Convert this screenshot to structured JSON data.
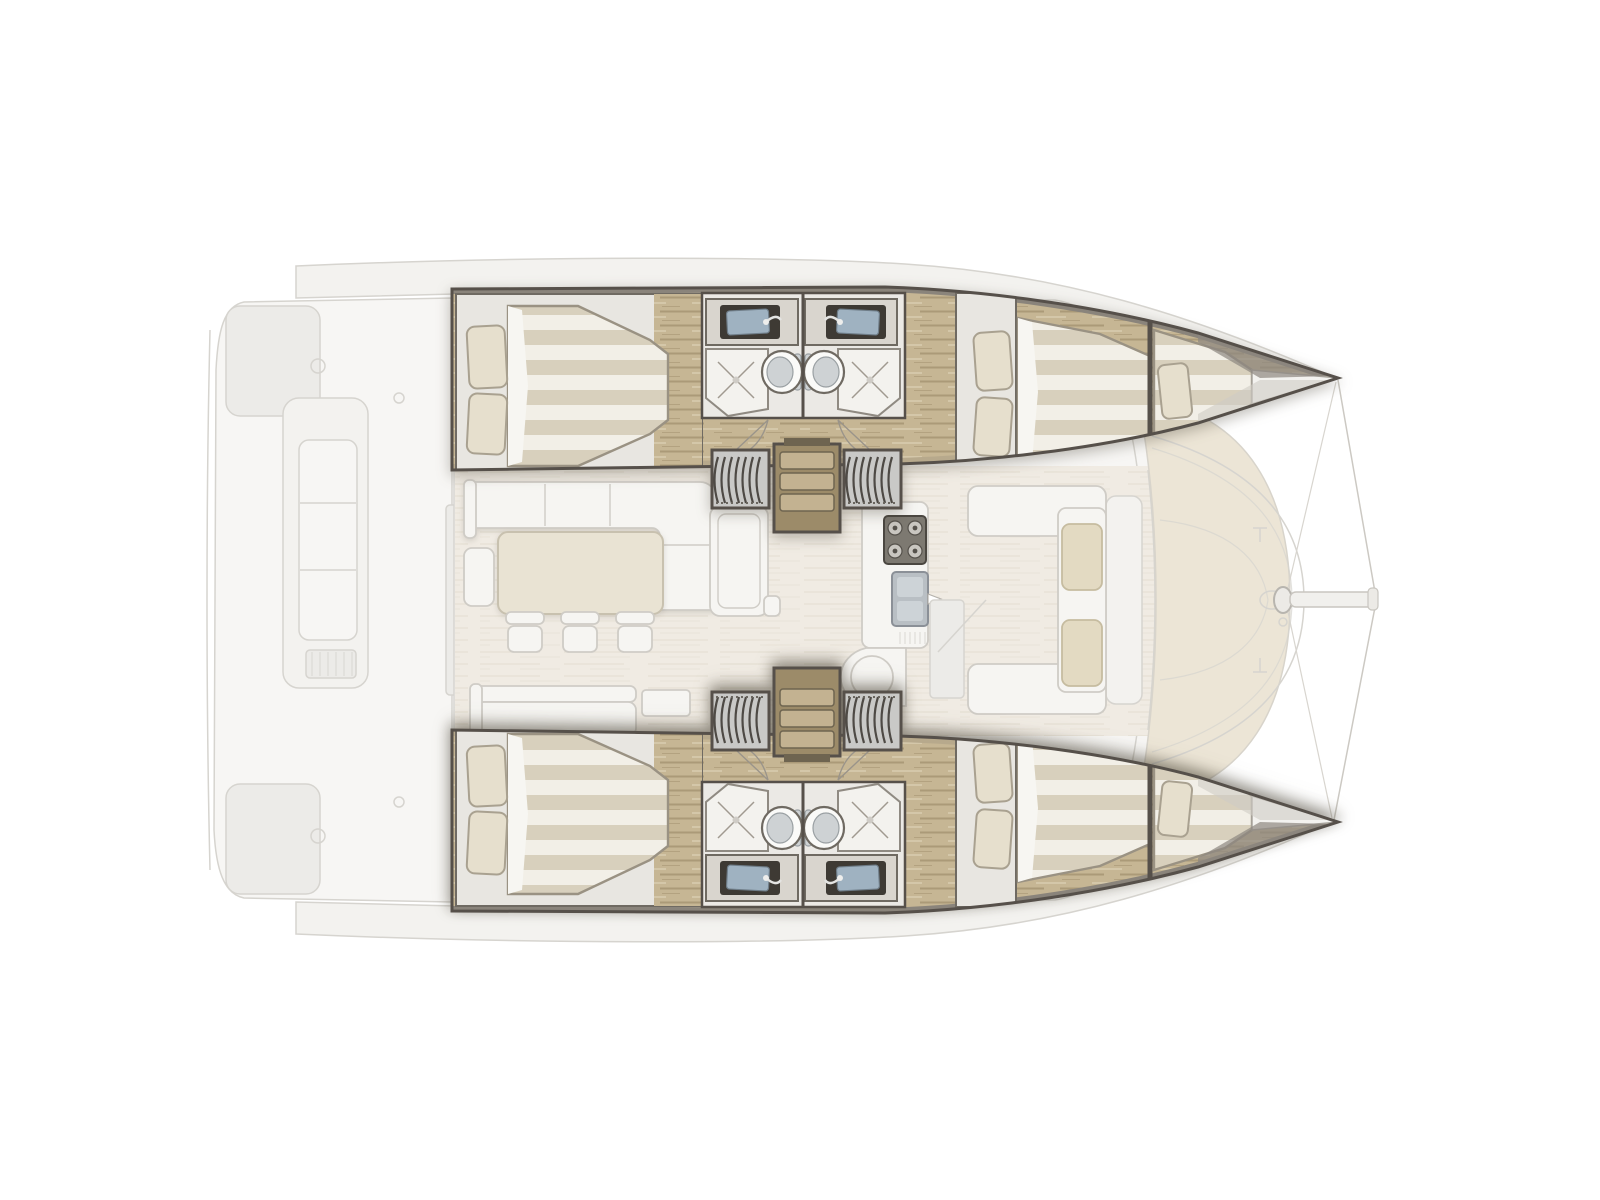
{
  "diagram": {
    "title": "Sailing catamaran interior layout plan, top view, bow to the right",
    "type": "boat-floor-plan",
    "orientation": {
      "bow": "right",
      "stern": "left",
      "top_hull": "port",
      "bottom_hull": "starboard"
    }
  },
  "inventory": {
    "hulls": 2,
    "double_cabins": 4,
    "forepeak_berths": 2,
    "bathrooms": 4,
    "toilets": 4,
    "hull_sinks": 4,
    "showers": 4,
    "companionway_stairs": 2,
    "dining_stools": 3,
    "cockpit_benches": 1,
    "forward_cockpit_cushions": 2
  },
  "rooms": {
    "port_hull": {
      "label": "Port hull (top) with two cabins and two bathrooms"
    },
    "starboard_hull": {
      "label": "Starboard hull (bottom), mirror of port hull"
    },
    "aft_cabin": {
      "label": "Aft double cabin with pillows and striped duvet"
    },
    "forward_cabin": {
      "label": "Forward double cabin with pillows and striped duvet"
    },
    "forepeak": {
      "label": "Forepeak single berth in the bow"
    },
    "bathrooms": {
      "label": "Two back-to-back bathrooms: sink vanity, toilet and shower each"
    },
    "companionway": {
      "label": "Companionway steps and ribbed sliding hatches down into the hull"
    },
    "saloon": {
      "label": "Saloon with L-shaped sofa, dining table and three stools"
    },
    "galley": {
      "label": "Galley with cooktop, sink and rounded peninsula counter"
    },
    "aft_cockpit": {
      "label": "Aft cockpit with long bench seat (faded exterior deck)"
    },
    "forward_cockpit": {
      "label": "Forward cockpit seating with two beige cushions"
    },
    "foredeck": {
      "label": "Foredeck / trampoline area with mast, crossbeam, bowsprit and forestays"
    }
  },
  "colors": {
    "bg": "#ffffff",
    "ghostLine": "#d6d4cf",
    "ghostFill": "#f3f2ef",
    "ghostSoft": "#ecebe8",
    "deckWhite": "#f7f6f4",
    "panelBeige": "#ece5d6",
    "saloonFloor": "#f0ebe3",
    "wall": "#56504a",
    "wallSoft": "#8a847b",
    "wood1": "#c6b694",
    "wood2": "#ab9a78",
    "woodLight": "#d9cdb0",
    "gunwale": "#b7a98c",
    "cabinPanel": "#e8e6e1",
    "duvetA": "#d8d0bd",
    "duvetB": "#f2efe7",
    "duvetEdge": "#9a9283",
    "pillow": "#e6dfcd",
    "pillowEdge": "#a9a190",
    "bathFloor": "#ebe9e5",
    "consoleTop": "#d9d5ce",
    "sinkFrame": "#3e3a34",
    "sinkSteel": "#9fb2c1",
    "fixWhite": "#fafaf8",
    "toiletLid": "#ced2d4",
    "fixEdge": "#6f6a62",
    "hatchBg": "#c9c9c7",
    "hatchRib": "#4e4a45",
    "stepTread": "#c3b291",
    "stepEdge": "#6e6450",
    "furnWhite": "#f6f5f2",
    "furnLine": "#cfccc6",
    "tableBeige": "#e9e3d3",
    "tableEdge": "#c8c1af",
    "cushion": "#e3dac2",
    "cushionEdge": "#c6bca0",
    "stove": "#7d7971",
    "steel": "#b9bfc4"
  }
}
